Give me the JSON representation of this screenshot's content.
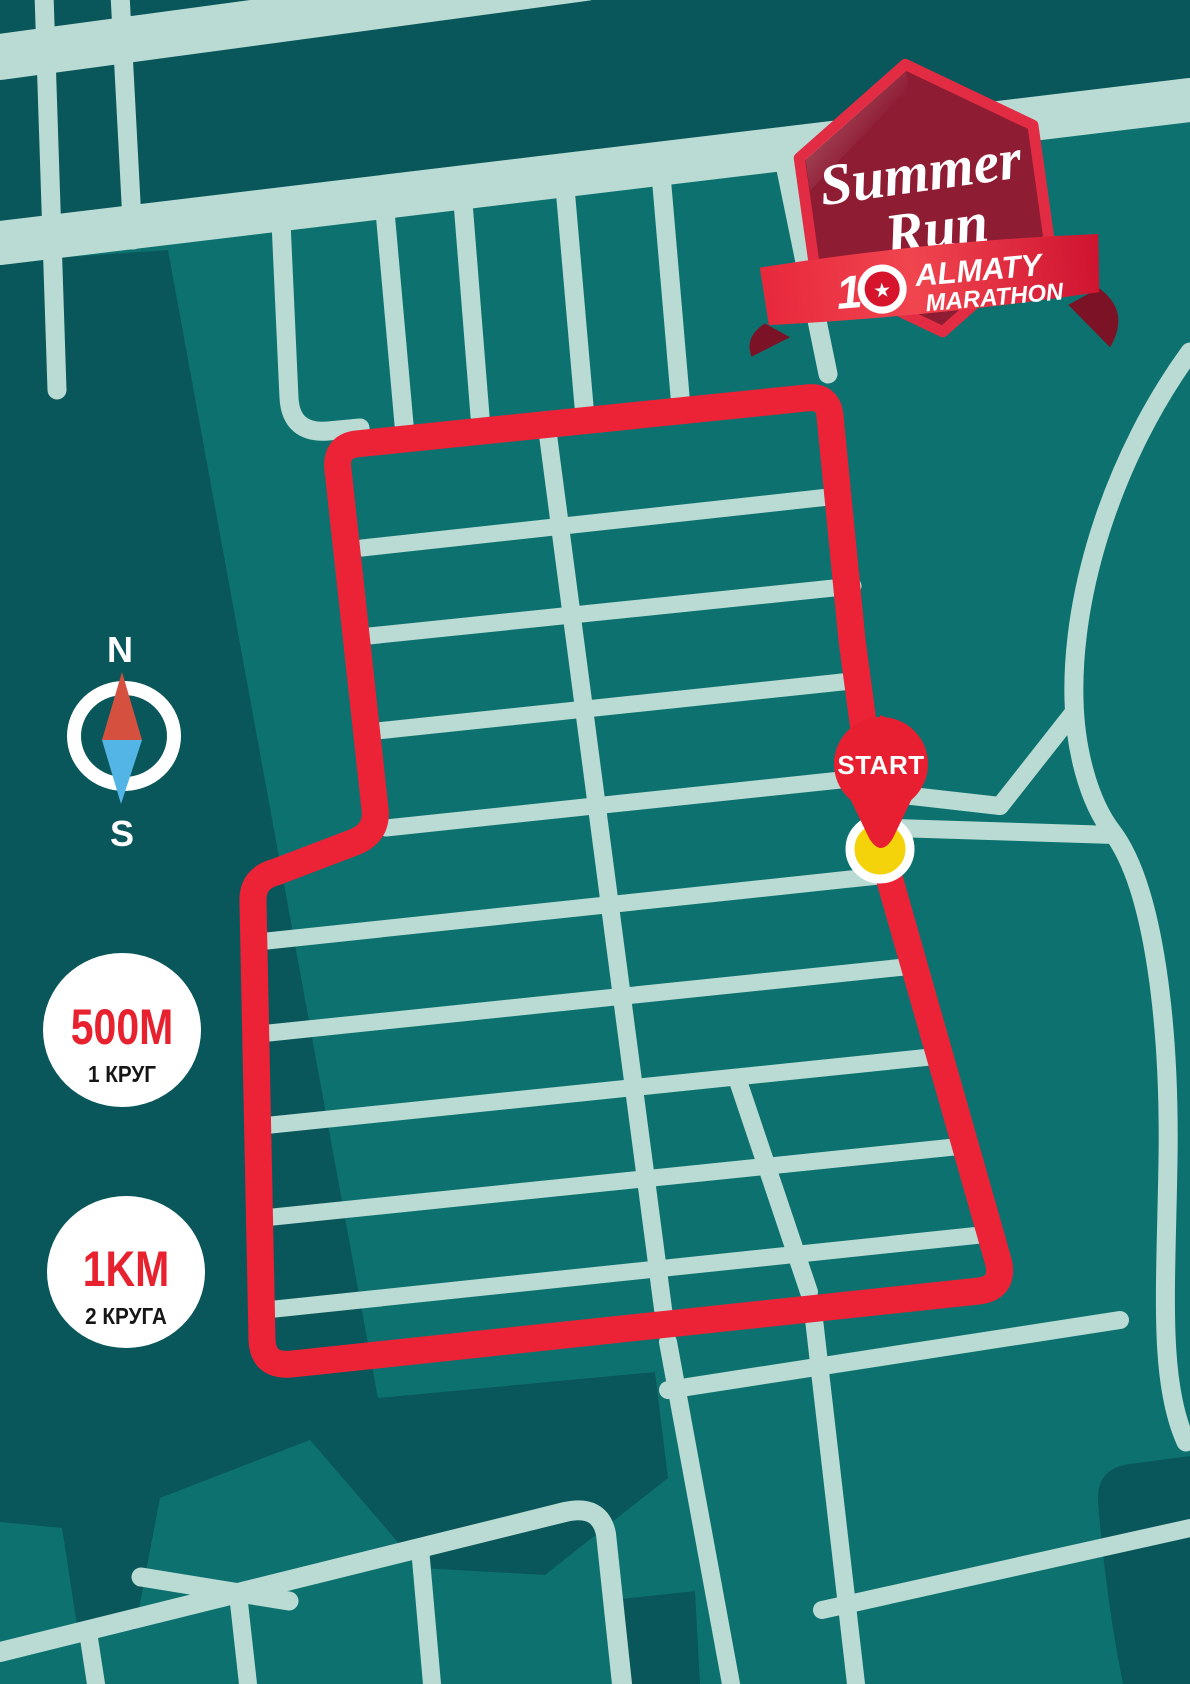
{
  "title": "Summer Run race route map",
  "compass": {
    "north": "N",
    "south": "S"
  },
  "badges": [
    {
      "distance": "500M",
      "laps": "1 КРУГ"
    },
    {
      "distance": "1KM",
      "laps": "2 КРУГА"
    }
  ],
  "start": {
    "label": "START"
  },
  "logo": {
    "title_line1": "Summer",
    "title_line2": "Run",
    "anniversary_number": "1",
    "anniversary_star": "★",
    "org_line1": "ALMATY",
    "org_line2": "MARATHON"
  },
  "colors": {
    "map_teal": "#0d726f",
    "map_dark_teal": "#0a575b",
    "street": "#b9dbd3",
    "route_red": "#ec2237",
    "pin_red": "#e81f30",
    "start_point_yellow": "#f4d30b",
    "badge_maroon": "#8e1c33",
    "badge_border_red": "#e22c43",
    "ribbon_red": "#d01330",
    "needle_north_red": "#d5503f",
    "needle_south_blue": "#53b5e5",
    "white": "#ffffff",
    "laps_text": "#161616"
  }
}
